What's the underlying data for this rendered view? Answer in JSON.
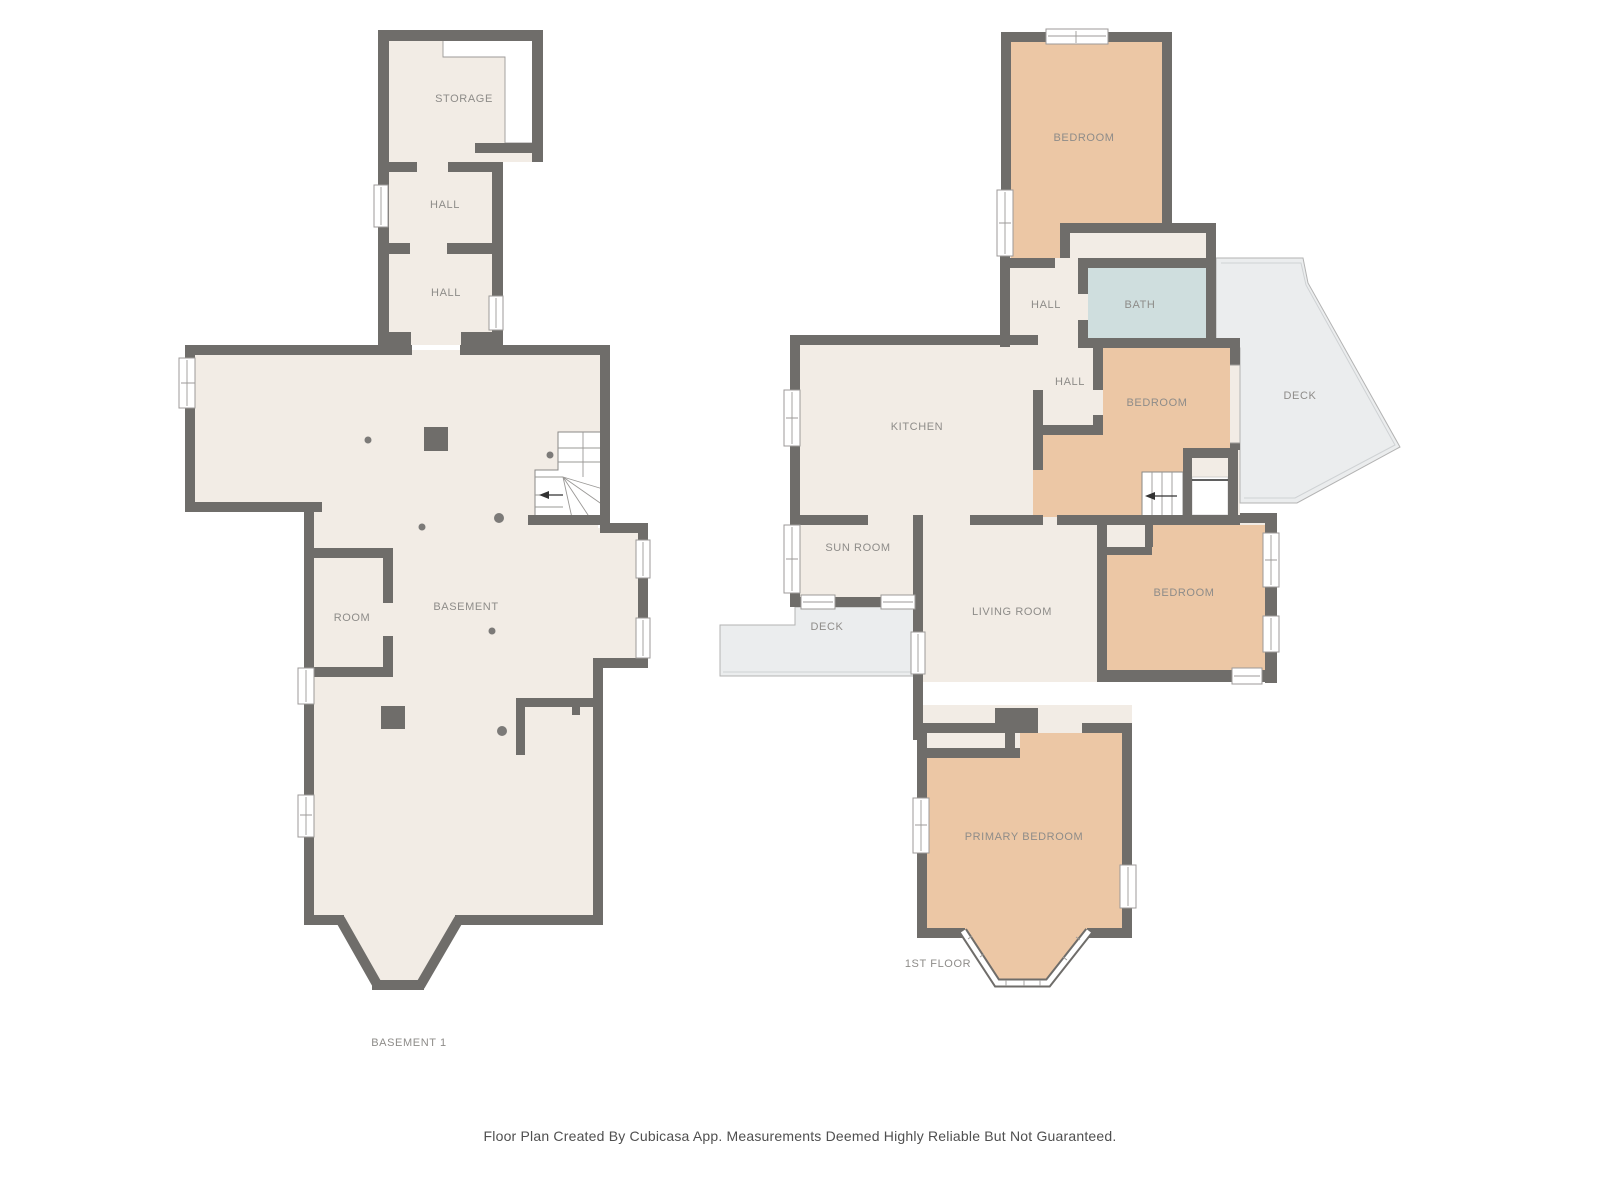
{
  "page": {
    "footer": "Floor Plan Created By Cubicasa App. Measurements Deemed Highly Reliable But Not Guaranteed."
  },
  "colors": {
    "wall": "#6f6d6a",
    "floor": "#f2ece5",
    "bedroom_fill": "#ecc7a5",
    "bath_fill": "#cfdede",
    "deck_fill": "#ebedee",
    "label_text": "#8e8c89",
    "footer_text": "#4f4f4f"
  },
  "basement": {
    "title": "BASEMENT 1",
    "rooms": {
      "storage": "STORAGE",
      "hall_upper": "HALL",
      "hall_lower": "HALL",
      "main": "BASEMENT",
      "room": "ROOM"
    }
  },
  "first_floor": {
    "title": "1ST FLOOR",
    "rooms": {
      "bedroom_top": "BEDROOM",
      "hall_upper": "HALL",
      "bath": "BATH",
      "hall_lower": "HALL",
      "deck_right": "DECK",
      "bedroom_middle": "BEDROOM",
      "kitchen": "KITCHEN",
      "sun_room": "SUN ROOM",
      "deck_left": "DECK",
      "living_room": "LIVING ROOM",
      "bedroom_lower": "BEDROOM",
      "primary_bedroom": "PRIMARY BEDROOM"
    }
  }
}
